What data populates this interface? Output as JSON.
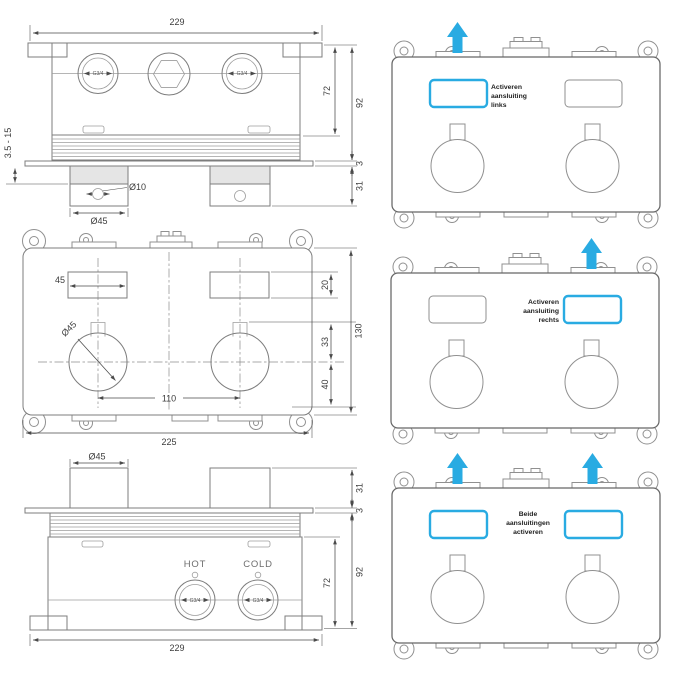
{
  "colors": {
    "accent": "#29abe2"
  },
  "drawing_top_section": {
    "dim_width": "229",
    "dim_body_depth": "72",
    "dim_total_depth": "92",
    "dim_plate_thickness": "3",
    "dim_handle_protrusion": "31",
    "dim_plaster_range": "3.5 - 15",
    "dim_pin_hole": "Ø10",
    "dim_handle_width": "Ø45",
    "port_left_thread": "G3/4",
    "port_right_thread": "G3/4"
  },
  "drawing_front_view": {
    "dim_slot_width": "45",
    "dim_handle_dia": "Ø45",
    "dim_handle_spacing": "110",
    "dim_body_width": "225",
    "dim_slot_height": "20",
    "dim_slot_to_center": "33",
    "dim_center_to_bottom": "40",
    "dim_body_height": "130"
  },
  "drawing_bottom_section": {
    "dim_handle_width": "Ø45",
    "dim_handle_protrusion": "31",
    "dim_plate_thickness": "3",
    "dim_body_depth": "72",
    "dim_total_depth": "92",
    "dim_width": "229",
    "label_hot": "HOT",
    "label_cold": "COLD",
    "port_hot_thread": "G3/4",
    "port_cold_thread": "G3/4"
  },
  "instruction_panels": [
    {
      "highlight": "left",
      "caption_lines": [
        "Activeren",
        "aansluiting",
        "links"
      ]
    },
    {
      "highlight": "right",
      "caption_lines": [
        "Activeren",
        "aansluiting",
        "rechts"
      ]
    },
    {
      "highlight": "both",
      "caption_lines": [
        "Beide",
        "aansluitingen",
        "activeren"
      ]
    }
  ]
}
